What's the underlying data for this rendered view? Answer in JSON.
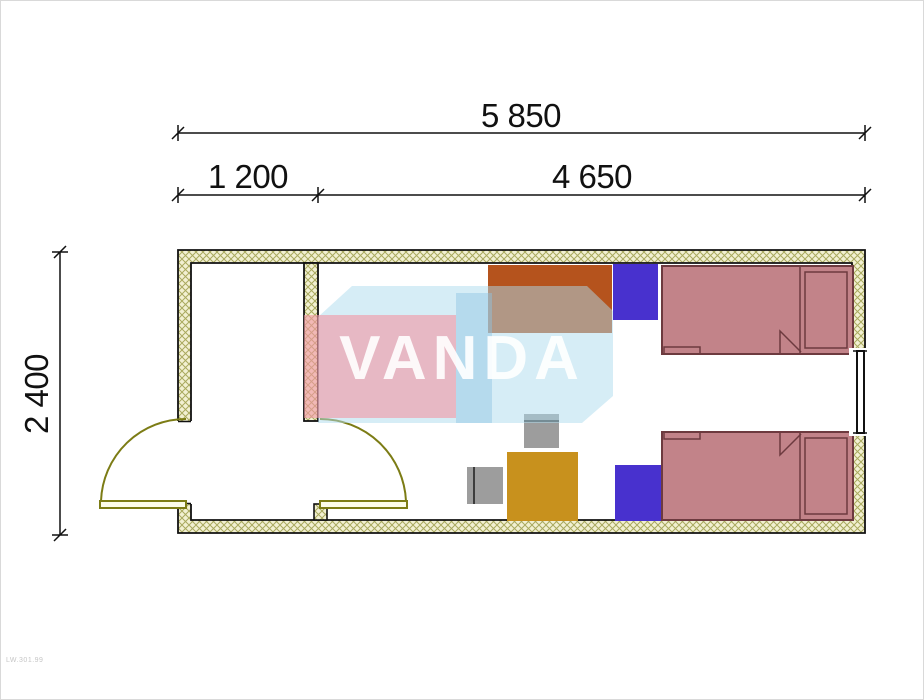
{
  "watermark": {
    "text": "VANDA"
  },
  "dimensions": {
    "overall_width": "5 850",
    "entry_width": "1 200",
    "room_width": "4 650",
    "height": "2 400"
  },
  "stamp": {
    "text": "LW.301.99"
  },
  "colors": {
    "outline": "#111111",
    "wall_fill": "#f2f0d2",
    "wall_hatch": "#a9a95e",
    "door": "#7c7c15",
    "door_leaf_fill": "#fcfce8",
    "bed": "#c28389",
    "bed_outline": "#6d3a3f",
    "desk": "#b5531d",
    "desk_outline": "#4a2a10",
    "nightstand": "#4831ce",
    "nightstand_outline": "#1c128f",
    "table": "#c8911d",
    "table_outline": "#6e5200",
    "chair": "#9d9d9d",
    "chair_outline": "#4a4a4a",
    "watermark_pink": "#f298a4",
    "watermark_blue": "#addbee",
    "watermark_blue_dark": "#8fc4e2"
  }
}
